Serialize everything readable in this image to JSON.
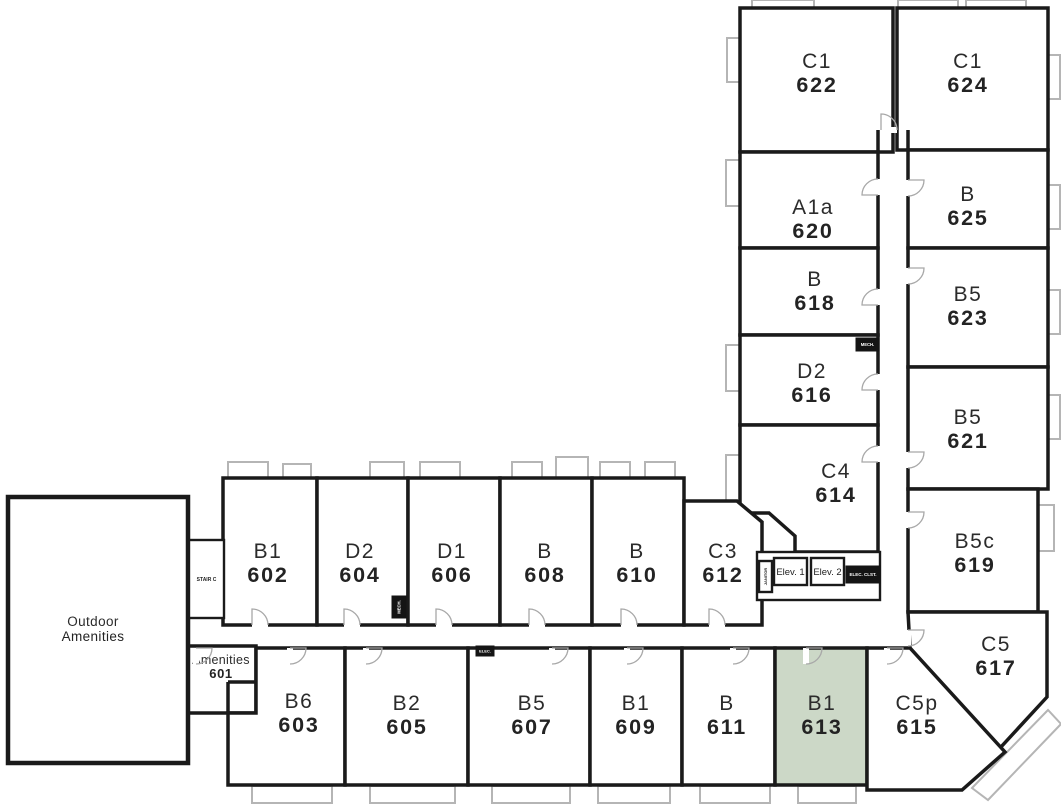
{
  "colors": {
    "wall": "#1a1a1a",
    "highlight": "#ccd8c7",
    "window_gray": "#b5b5b5",
    "text": "#2b2b2b"
  },
  "highlighted_unit": {
    "type": "B1",
    "number": "613"
  },
  "rooms": [
    {
      "name": "unit-622",
      "line1": "C1",
      "line2": "622",
      "points": "740,8 893,8 893,152 740,152",
      "lx": 817,
      "ly": 72,
      "style": "lg"
    },
    {
      "name": "unit-624",
      "line1": "C1",
      "line2": "624",
      "points": "897,8 1048,8 1048,150 897,150",
      "lx": 968,
      "ly": 72,
      "style": "lg"
    },
    {
      "name": "unit-620",
      "line1": "A1a",
      "line2": "620",
      "points": "740,152 878,152 878,248 740,248",
      "lx": 813,
      "ly": 218,
      "style": "lg"
    },
    {
      "name": "unit-625",
      "line1": "B",
      "line2": "625",
      "points": "908,150 1048,150 1048,248 908,248",
      "lx": 968,
      "ly": 205,
      "style": "lg"
    },
    {
      "name": "unit-618",
      "line1": "B",
      "line2": "618",
      "points": "740,248 878,248 878,335 740,335",
      "lx": 815,
      "ly": 290,
      "style": "lg"
    },
    {
      "name": "unit-623",
      "line1": "B5",
      "line2": "623",
      "points": "908,248 1048,248 1048,367 908,367",
      "lx": 968,
      "ly": 305,
      "style": "lg"
    },
    {
      "name": "unit-616",
      "line1": "D2",
      "line2": "616",
      "points": "740,335 878,335 878,425 740,425",
      "lx": 812,
      "ly": 382,
      "style": "lg"
    },
    {
      "name": "unit-621",
      "line1": "B5",
      "line2": "621",
      "points": "908,367 1048,367 1048,489 908,489",
      "lx": 968,
      "ly": 428,
      "style": "lg"
    },
    {
      "name": "unit-614",
      "line1": "C4",
      "line2": "614",
      "points": "740,425 878,425 878,552 795,552 795,536 769,513 740,513",
      "lx": 836,
      "ly": 482,
      "style": "lg"
    },
    {
      "name": "unit-619",
      "line1": "B5c",
      "line2": "619",
      "points": "908,489 1038,489 1038,612 908,612",
      "lx": 975,
      "ly": 552,
      "style": "lg"
    },
    {
      "name": "unit-617",
      "line1": "C5",
      "line2": "617",
      "points": "908,612 1047,612 1047,697 1000,748 910,648",
      "lx": 996,
      "ly": 655,
      "style": "lg"
    },
    {
      "name": "unit-602",
      "line1": "B1",
      "line2": "602",
      "points": "223,478 317,478 317,625 223,625",
      "lx": 268,
      "ly": 562,
      "style": "lg"
    },
    {
      "name": "unit-604",
      "line1": "D2",
      "line2": "604",
      "points": "317,478 408,478 408,625 317,625",
      "lx": 360,
      "ly": 562,
      "style": "lg"
    },
    {
      "name": "unit-606",
      "line1": "D1",
      "line2": "606",
      "points": "408,478 500,478 500,625 408,625",
      "lx": 452,
      "ly": 562,
      "style": "lg"
    },
    {
      "name": "unit-608",
      "line1": "B",
      "line2": "608",
      "points": "500,478 592,478 592,625 500,625",
      "lx": 545,
      "ly": 562,
      "style": "lg"
    },
    {
      "name": "unit-610",
      "line1": "B",
      "line2": "610",
      "points": "592,478 684,478 684,625 592,625",
      "lx": 637,
      "ly": 562,
      "style": "lg"
    },
    {
      "name": "unit-612",
      "line1": "C3",
      "line2": "612",
      "points": "684,501 737,501 762,522 762,625 684,625",
      "lx": 723,
      "ly": 562,
      "style": "lg"
    },
    {
      "name": "amenities-601",
      "line1": "Amenities",
      "line2": "601",
      "points": "188,646 256,646 256,713 188,713",
      "lx": 221,
      "ly": 666,
      "style": "sm"
    },
    {
      "name": "unit-603",
      "line1": "B6",
      "line2": "603",
      "points": "256,648 345,648 345,785 228,785 228,713 256,713",
      "lx": 299,
      "ly": 712,
      "style": "lg"
    },
    {
      "name": "unit-605",
      "line1": "B2",
      "line2": "605",
      "points": "345,648 468,648 468,785 345,785",
      "lx": 407,
      "ly": 714,
      "style": "lg"
    },
    {
      "name": "unit-607",
      "line1": "B5",
      "line2": "607",
      "points": "468,648 590,648 590,785 468,785",
      "lx": 532,
      "ly": 714,
      "style": "lg"
    },
    {
      "name": "unit-609",
      "line1": "B1",
      "line2": "609",
      "points": "590,648 682,648 682,785 590,785",
      "lx": 636,
      "ly": 714,
      "style": "lg"
    },
    {
      "name": "unit-611",
      "line1": "B",
      "line2": "611",
      "points": "682,648 775,648 775,785 682,785",
      "lx": 727,
      "ly": 714,
      "style": "lg"
    },
    {
      "name": "unit-613",
      "line1": "B1",
      "line2": "613",
      "points": "775,648 867,648 867,785 775,785",
      "lx": 822,
      "ly": 714,
      "style": "lg",
      "highlighted": true
    },
    {
      "name": "unit-615",
      "line1": "C5p",
      "line2": "615",
      "points": "867,648 910,648 1005,752 962,790 867,790",
      "lx": 917,
      "ly": 714,
      "style": "lg"
    },
    {
      "name": "outdoor-amenities",
      "line1": "Outdoor",
      "line2": "Amenities",
      "points": "8,497 188,497 188,763 8,763",
      "lx": 93,
      "ly": 628,
      "style": "area"
    }
  ],
  "service": [
    {
      "name": "elevator-lobby",
      "label": "",
      "x": 757,
      "y": 552,
      "w": 123,
      "h": 48,
      "kind": "outline",
      "fs": 0
    },
    {
      "name": "stair-c",
      "label": "STAIR C",
      "x": 189,
      "y": 540,
      "w": 35,
      "h": 78,
      "kind": "outline",
      "fs": 5,
      "bold": true
    },
    {
      "name": "elevator-1",
      "label": "Elev. 1",
      "x": 774,
      "y": 558,
      "w": 33,
      "h": 27,
      "kind": "outline",
      "fs": 9.5
    },
    {
      "name": "elevator-2",
      "label": "Elev. 2",
      "x": 811,
      "y": 558,
      "w": 33,
      "h": 27,
      "kind": "outline",
      "fs": 9.5
    },
    {
      "name": "elec-closet",
      "label": "ELEC. CLST.",
      "x": 846,
      "y": 566,
      "w": 34,
      "h": 17,
      "kind": "solid",
      "fs": 4.5
    },
    {
      "name": "janitor-closet",
      "label": "JANITOR",
      "x": 759,
      "y": 561,
      "w": 13,
      "h": 31,
      "kind": "outline",
      "fs": 4,
      "vertical": true,
      "bold": true
    },
    {
      "name": "mech-closet-tower",
      "label": "MECH.",
      "x": 856,
      "y": 338,
      "w": 23,
      "h": 13,
      "kind": "solid",
      "fs": 4.2
    },
    {
      "name": "mech-closet-wing",
      "label": "MECH.",
      "x": 392,
      "y": 596,
      "w": 14,
      "h": 22,
      "kind": "solid",
      "fs": 4.2,
      "vertical": true
    },
    {
      "name": "elec-closet-wing",
      "label": "ELEC.",
      "x": 476,
      "y": 646,
      "w": 18,
      "h": 10,
      "kind": "solid",
      "fs": 4
    }
  ],
  "doors": [
    {
      "x": 252,
      "y": 625,
      "rot": 0
    },
    {
      "x": 344,
      "y": 625,
      "rot": 0
    },
    {
      "x": 436,
      "y": 625,
      "rot": 0
    },
    {
      "x": 529,
      "y": 625,
      "rot": 0
    },
    {
      "x": 621,
      "y": 625,
      "rot": 0
    },
    {
      "x": 709,
      "y": 625,
      "rot": 0
    },
    {
      "x": 290,
      "y": 648,
      "rot": 90
    },
    {
      "x": 366,
      "y": 648,
      "rot": 90
    },
    {
      "x": 552,
      "y": 648,
      "rot": 90
    },
    {
      "x": 627,
      "y": 648,
      "rot": 90
    },
    {
      "x": 733,
      "y": 648,
      "rot": 90
    },
    {
      "x": 806,
      "y": 648,
      "rot": 90
    },
    {
      "x": 887,
      "y": 648,
      "rot": 90
    },
    {
      "x": 196,
      "y": 648,
      "rot": 90
    },
    {
      "x": 878,
      "y": 195,
      "rot": 270
    },
    {
      "x": 878,
      "y": 305,
      "rot": 270
    },
    {
      "x": 878,
      "y": 390,
      "rot": 270
    },
    {
      "x": 878,
      "y": 462,
      "rot": 270
    },
    {
      "x": 908,
      "y": 180,
      "rot": 90
    },
    {
      "x": 908,
      "y": 268,
      "rot": 90
    },
    {
      "x": 908,
      "y": 452,
      "rot": 90
    },
    {
      "x": 908,
      "y": 512,
      "rot": 90
    },
    {
      "x": 908,
      "y": 630,
      "rot": 90
    },
    {
      "x": 881,
      "y": 130,
      "rot": 0
    }
  ],
  "bays": [
    [
      752,
      0,
      62,
      9
    ],
    [
      898,
      0,
      60,
      9
    ],
    [
      966,
      0,
      60,
      9
    ],
    [
      727,
      38,
      13,
      44
    ],
    [
      726,
      160,
      14,
      46
    ],
    [
      726,
      345,
      14,
      46
    ],
    [
      726,
      455,
      14,
      46
    ],
    [
      1048,
      55,
      12,
      44
    ],
    [
      1048,
      185,
      12,
      44
    ],
    [
      1048,
      290,
      12,
      44
    ],
    [
      1048,
      395,
      12,
      44
    ],
    [
      1038,
      505,
      16,
      46
    ],
    [
      228,
      462,
      40,
      16
    ],
    [
      283,
      464,
      28,
      14
    ],
    [
      370,
      462,
      34,
      16
    ],
    [
      420,
      462,
      40,
      16
    ],
    [
      512,
      462,
      30,
      16
    ],
    [
      556,
      457,
      32,
      21
    ],
    [
      600,
      462,
      30,
      16
    ],
    [
      645,
      462,
      30,
      16
    ],
    [
      252,
      786,
      80,
      17
    ],
    [
      370,
      786,
      85,
      17
    ],
    [
      492,
      786,
      78,
      17
    ],
    [
      598,
      786,
      72,
      17
    ],
    [
      700,
      786,
      70,
      17
    ],
    [
      798,
      786,
      58,
      17
    ]
  ],
  "balcony_diagonal": "972,788 1048,710 1061,724 988,800",
  "extra_walls": [
    [
      878,
      130,
      878,
      152
    ],
    [
      908,
      130,
      908,
      150
    ],
    [
      228,
      682,
      256,
      682
    ],
    [
      228,
      682,
      228,
      713
    ]
  ]
}
